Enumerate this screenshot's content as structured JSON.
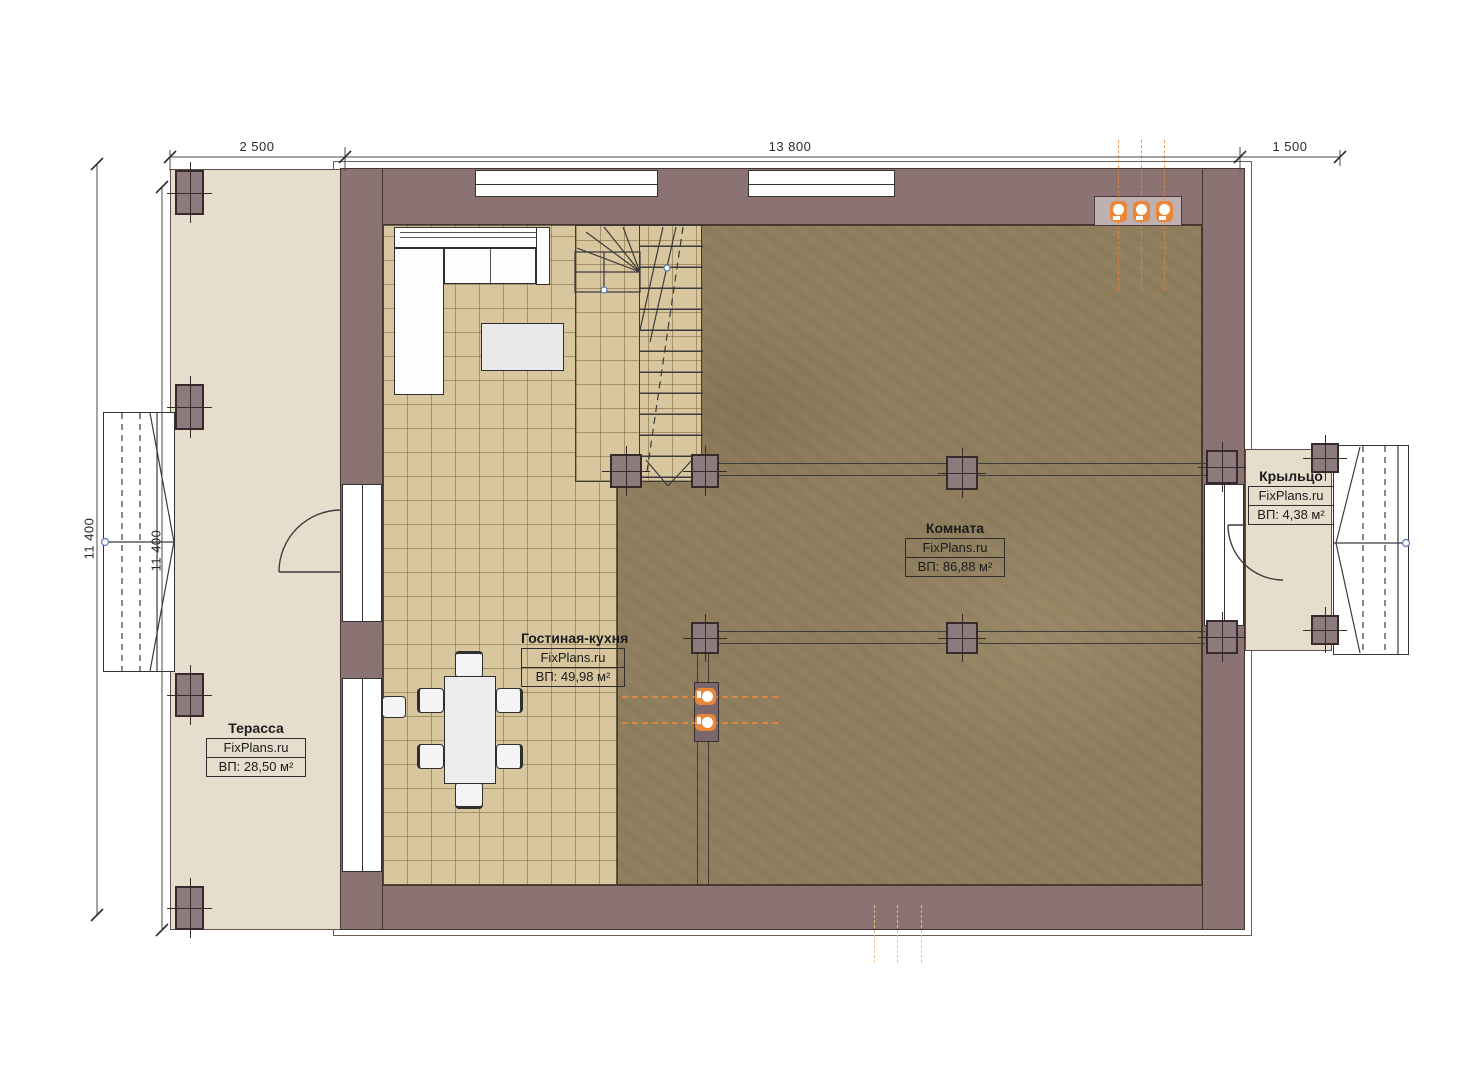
{
  "dimensions": {
    "top": [
      "2 500",
      "13 800",
      "1 500"
    ],
    "left": [
      "11 400",
      "11 400"
    ]
  },
  "rooms": {
    "terrace": {
      "name": "Терасса",
      "brand": "FixPlans.ru",
      "area": "ВП: 28,50 м²"
    },
    "living": {
      "name": "Гостиная-кухня",
      "brand": "FixPlans.ru",
      "area": "ВП: 49,98 м²"
    },
    "room": {
      "name": "Комната",
      "brand": "FixPlans.ru",
      "area": "ВП: 86,88 м²"
    },
    "porch": {
      "name": "Крыльцо",
      "brand": "FixPlans.ru",
      "area": "ВП: 4,38 м²"
    }
  },
  "colors": {
    "wall": "#8b7373",
    "terrace_floor": "#e6ddcd",
    "tile_floor": "#d8c69e",
    "room_floor": "#90805f",
    "accent_orange": "#e8873a"
  }
}
